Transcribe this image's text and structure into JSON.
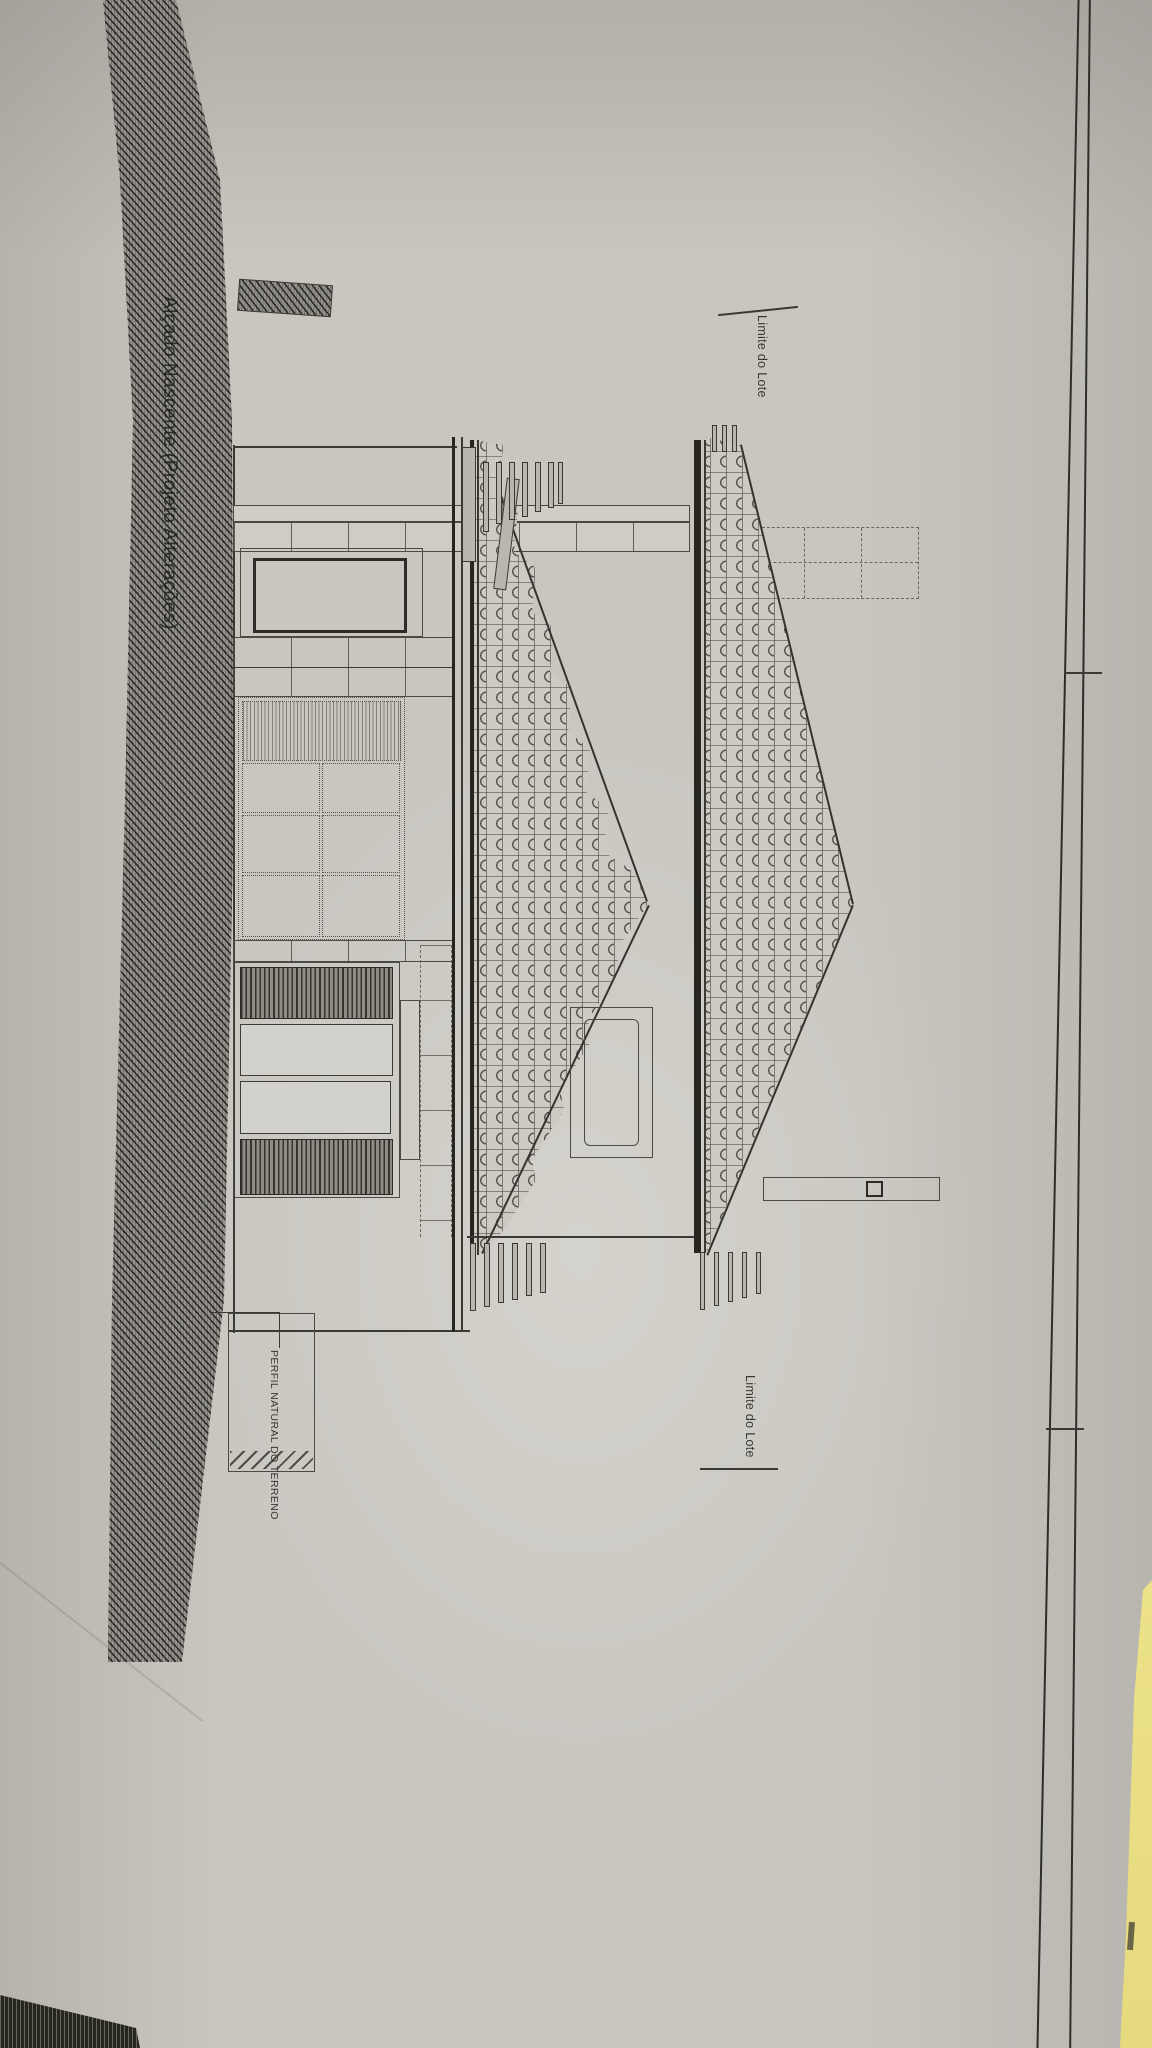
{
  "drawing": {
    "title": "Alçado Nascente (Projeto Alterações)",
    "labels": {
      "lot_boundary_top": "Limite do Lote",
      "lot_boundary_bottom": "Limite do Lote",
      "terrain_profile": "PERFIL NATURAL DO TERRENO"
    },
    "colors": {
      "paper": "#c9c6c0",
      "ink": "#3a3934",
      "terrain_hatch_base": "#94928b",
      "yellow_sheet": "#ece289",
      "dark_corner_strip": "#26261f"
    }
  }
}
